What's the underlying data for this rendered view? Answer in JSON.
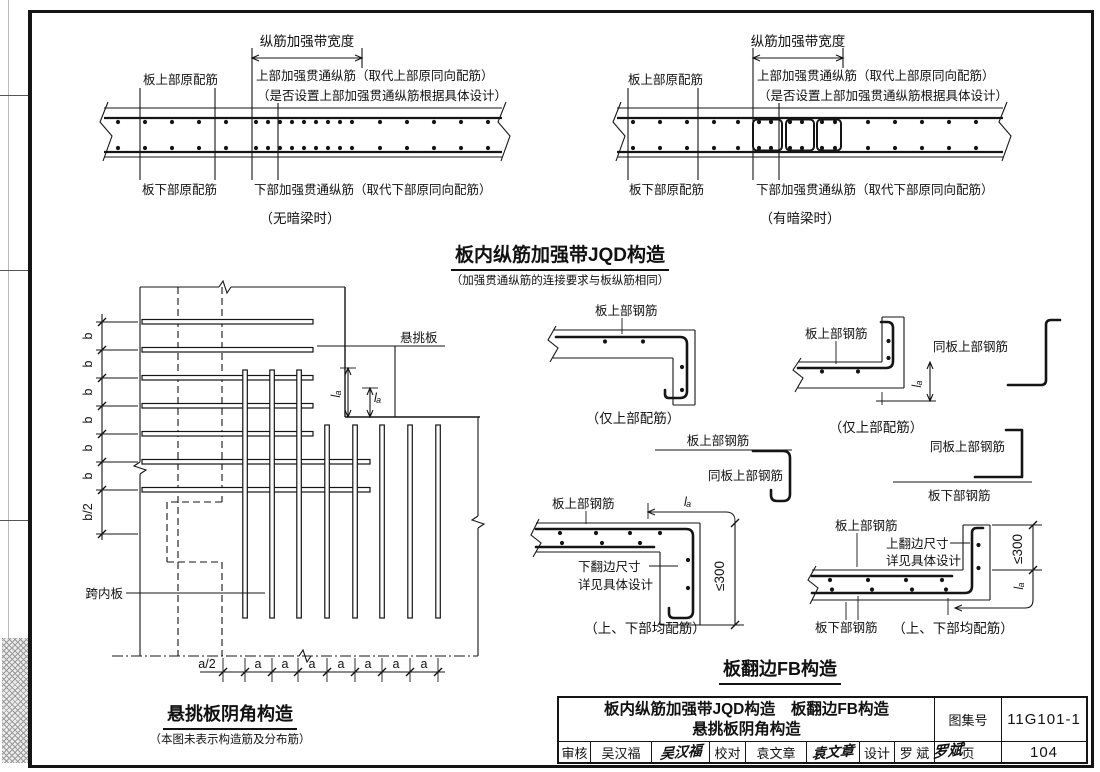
{
  "jqd": {
    "band_width": "纵筋加强带宽度",
    "top_orig": "板上部原配筋",
    "top_add": "上部加强贯通纵筋（取代上部原同向配筋）",
    "top_note": "（是否设置上部加强贯通纵筋根据具体设计）",
    "bottom_orig": "板下部原配筋",
    "bottom_add": "下部加强贯通纵筋（取代下部原同向配筋）",
    "caption_no_beam": "（无暗梁时）",
    "caption_beam": "（有暗梁时）",
    "title": "板内纵筋加强带JQD构造",
    "subtitle": "（加强贯通纵筋的连接要求与板纵筋相同）"
  },
  "corner": {
    "cantilever": "悬挑板",
    "span_slab": "跨内板",
    "b": "b",
    "b_half": "b/2",
    "a": "a",
    "a_half": "a/2",
    "la": "lₐ",
    "title": "悬挑板阴角构造",
    "subtitle": "（本图未表示构造筋及分布筋）"
  },
  "fb": {
    "top_bar": "板上部钢筋",
    "bottom_bar": "板下部钢筋",
    "same_top_bar": "同板上部钢筋",
    "only_top": "（仅上部配筋）",
    "both_bars": "（上、下部均配筋）",
    "down_edge_1": "下翻边尺寸",
    "down_edge_2": "详见具体设计",
    "up_edge_1": "上翻边尺寸",
    "up_edge_2": "详见具体设计",
    "le300": "≤300",
    "la": "lₐ",
    "title": "板翻边FB构造"
  },
  "titleblock": {
    "title_line1": "板内纵筋加强带JQD构造　板翻边FB构造",
    "title_line2": "悬挑板阴角构造",
    "check_label": "审核",
    "check_name": "吴汉福",
    "check_sig": "吴汉福",
    "proof_label": "校对",
    "proof_name": "袁文章",
    "proof_sig": "袁文章",
    "design_label": "设计",
    "design_name": "罗  斌",
    "design_sig": "罗斌",
    "atlas_label": "图集号",
    "atlas_no": "11G101-1",
    "page_label": "页",
    "page_no": "104"
  }
}
